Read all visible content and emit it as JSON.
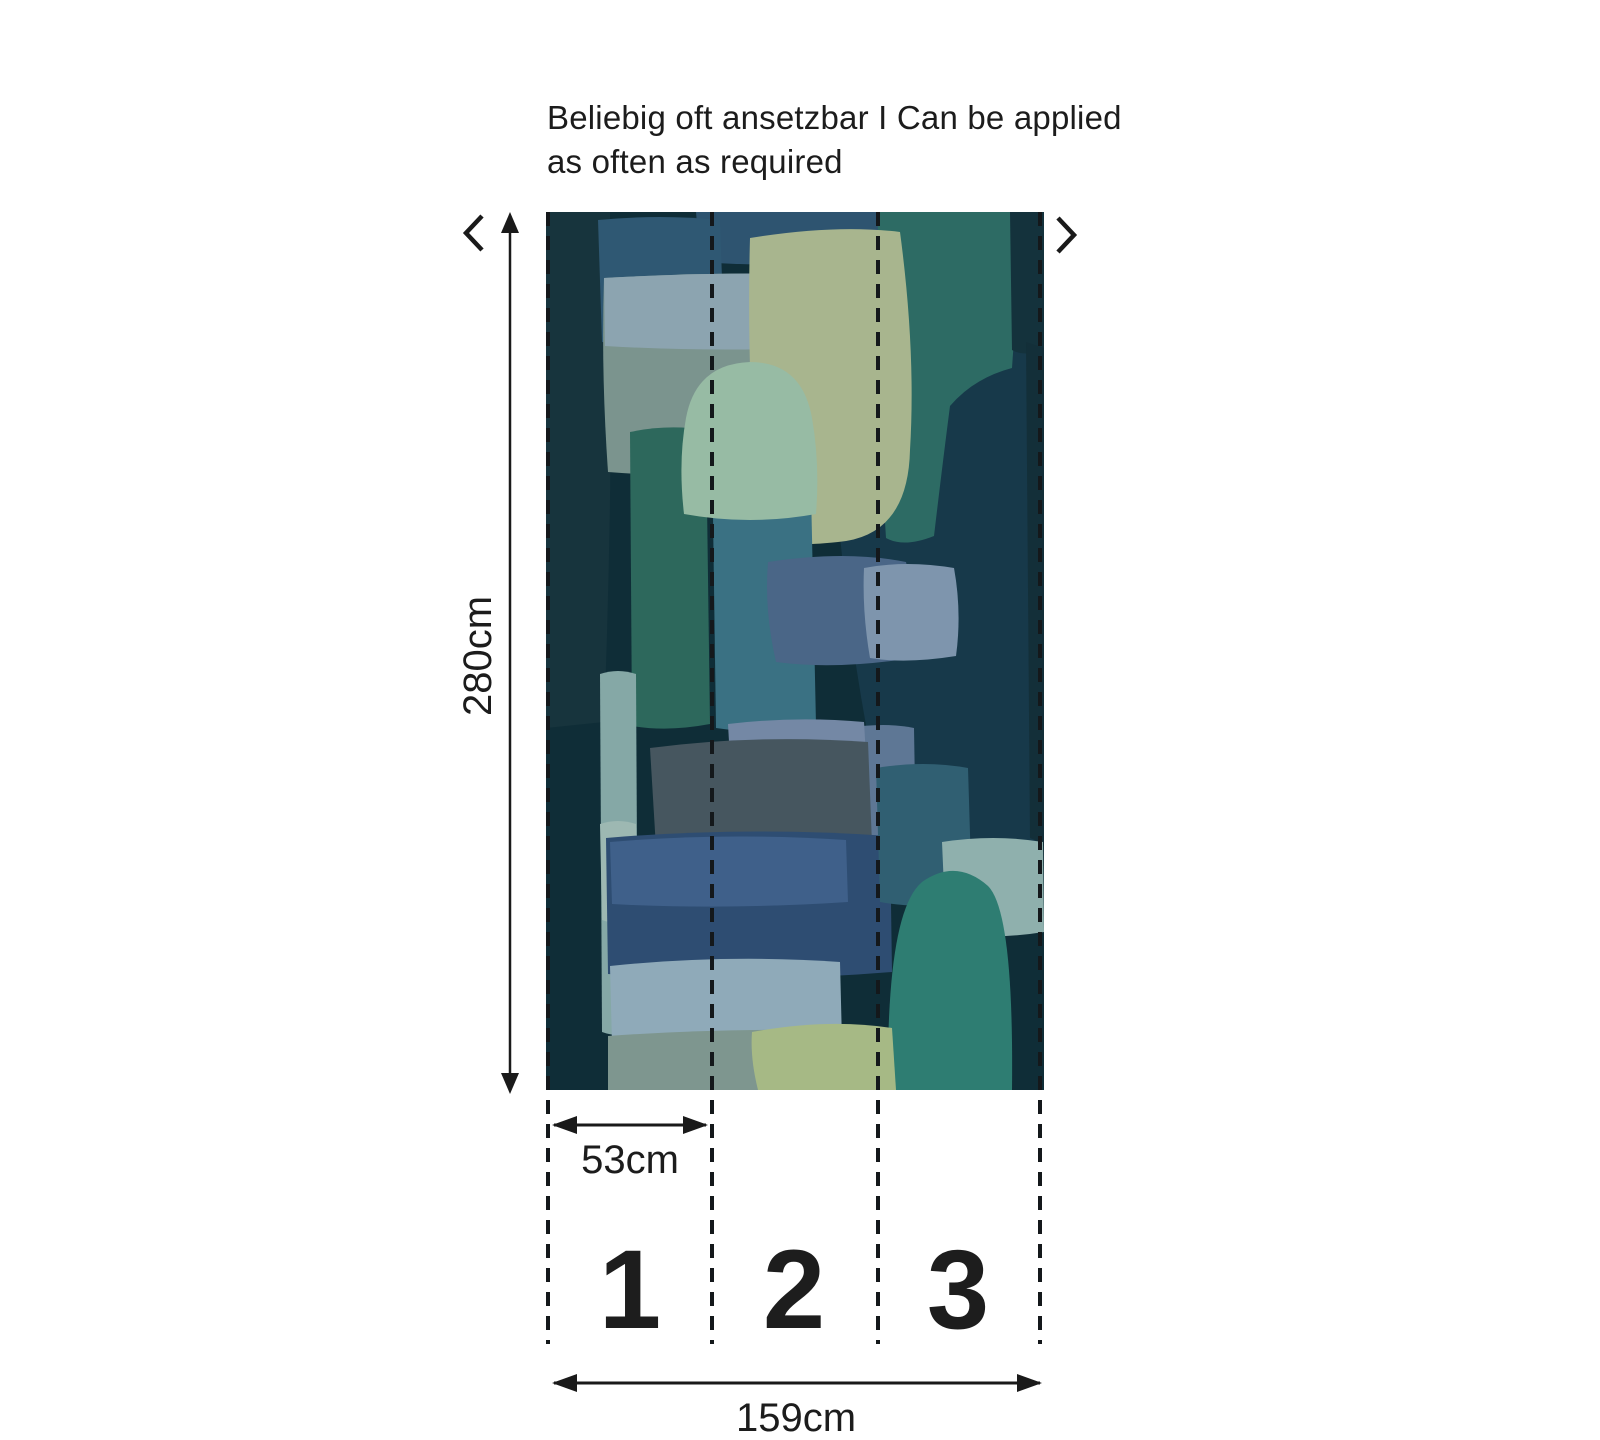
{
  "annotation": {
    "line1": "Beliebig oft ansetzbar I Can be applied",
    "line2": "as often as required"
  },
  "dimensions": {
    "height": "280cm",
    "panel_width": "53cm",
    "total_width": "159cm"
  },
  "panels": [
    "1",
    "2",
    "3"
  ],
  "palette": {
    "line": "#1a1a1a",
    "bg": "#0f2d37",
    "leftCol": "#17343d",
    "navyMidRight": "#17394a",
    "topNavyBand": "#2e5470",
    "blueRect": "#2f5873",
    "mutedPanel": "#7b948e",
    "lightBand": "#8ca4b0",
    "tealCol": "#2d6b64",
    "rightStripTop": "#14323c",
    "rightStripMid": "#132f39",
    "sage": "#a8b58e",
    "greenCol": "#2d685c",
    "blueTealCol": "#3a7183",
    "dome": "#97bba4",
    "steelBlob": "#4a6687",
    "lightSteelPatch": "#7e95ad",
    "leftLightTealCol": "#85a8a6",
    "lightTealBand": "#9db8b2",
    "slate": "#46565f",
    "steelRegion": "#5e7795",
    "lighterTopBand": "#7488a5",
    "navyRect": "#2e4d72",
    "navyRectTop": "#3f608a",
    "archRemnant": "#305f72",
    "lightRectBr": "#8fb0ad",
    "arch": "#2e7d72",
    "lightBlueBand": "#8faab9",
    "greyBand": "#7e968f",
    "yellowBlob": "#a6b985"
  }
}
